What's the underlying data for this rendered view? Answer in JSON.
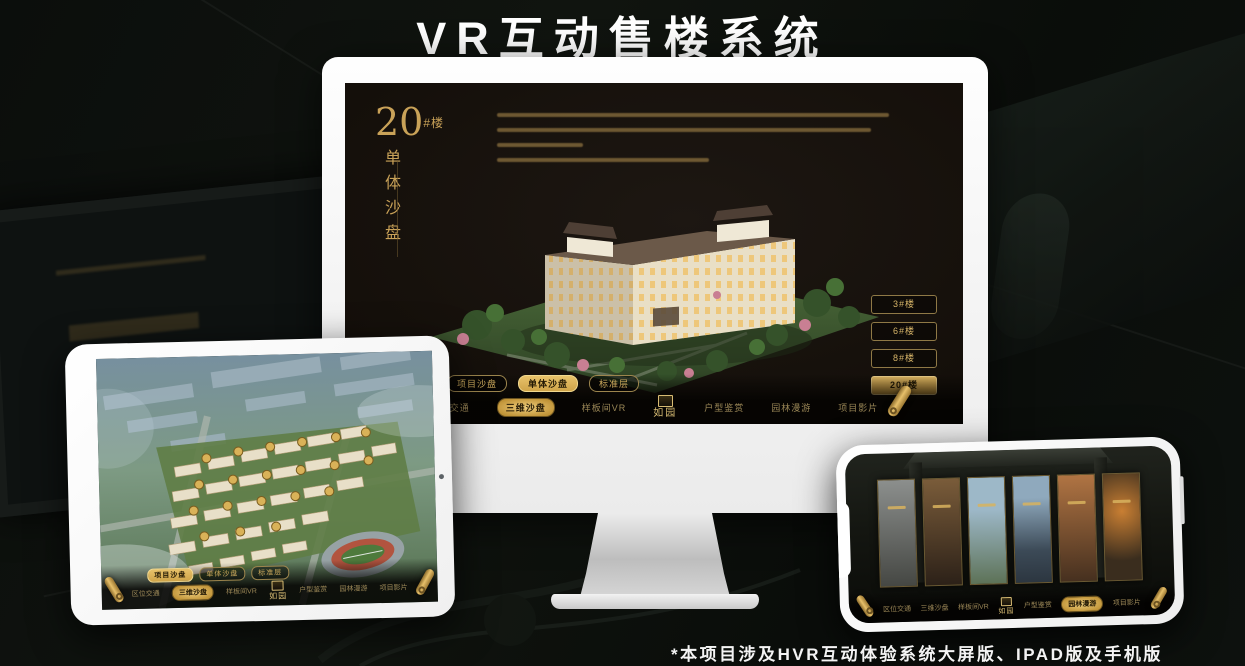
{
  "page": {
    "title": "VR互动售楼系统",
    "footnote": "*本项目涉及HVR互动体验系统大屏版、IPAD版及手机版"
  },
  "colors": {
    "gold_accent": "#c9a258",
    "gold_bright": "#e3b964",
    "gold_dim": "#9b8757",
    "screen_background": "#16110c",
    "page_background": "#0a0d0b",
    "device_frame": "#ffffff"
  },
  "nav": {
    "logo": "如园",
    "items": [
      {
        "label": "区位交通"
      },
      {
        "label": "三维沙盘"
      },
      {
        "label": "样板间VR"
      },
      {
        "label": "户型鉴赏"
      },
      {
        "label": "园林漫游"
      },
      {
        "label": "项目影片"
      }
    ]
  },
  "sandtable_tabs": [
    {
      "label": "项目沙盘"
    },
    {
      "label": "单体沙盘"
    },
    {
      "label": "标准层"
    }
  ],
  "monitor": {
    "building_no": "20",
    "building_no_suffix": "#楼",
    "building_subtitle": "单体沙盘",
    "active_tab": "单体沙盘",
    "active_nav": "三维沙盘",
    "floor_buttons": [
      {
        "label": "3#楼",
        "active": false
      },
      {
        "label": "6#楼",
        "active": false
      },
      {
        "label": "8#楼",
        "active": false
      },
      {
        "label": "20#楼",
        "active": true
      }
    ]
  },
  "tablet": {
    "active_tab": "项目沙盘",
    "active_nav": "三维沙盘"
  },
  "phone": {
    "active_nav": "园林漫游",
    "panel_count": 6
  }
}
